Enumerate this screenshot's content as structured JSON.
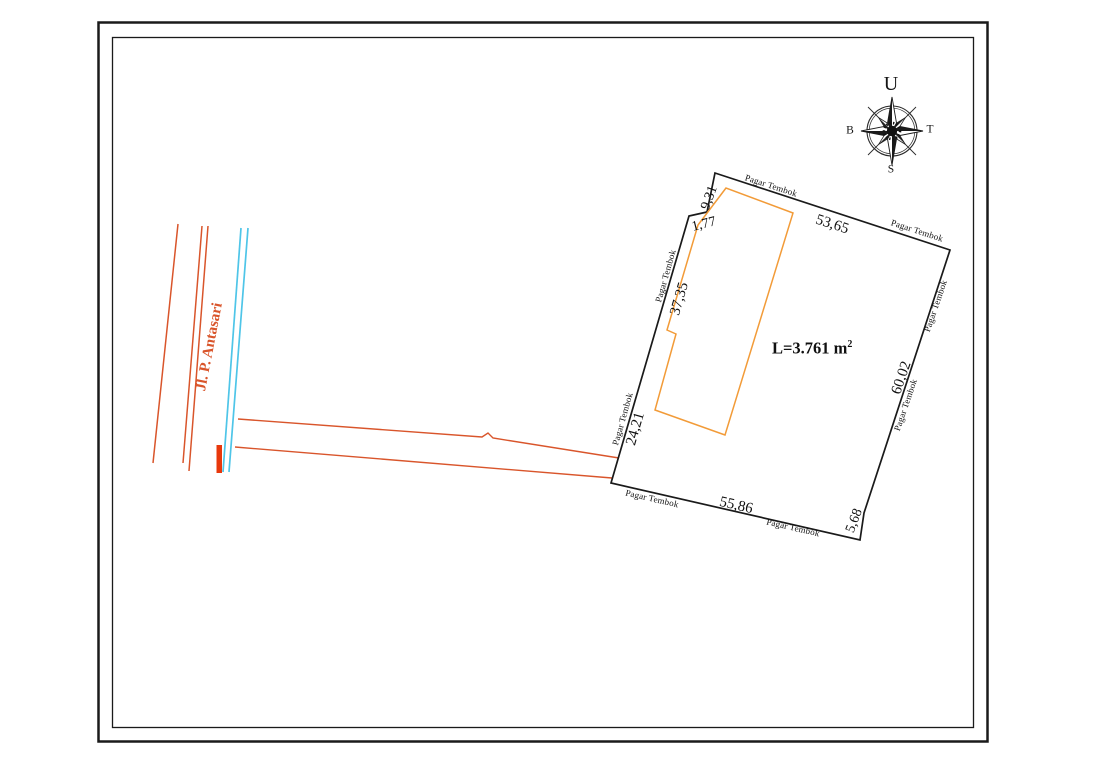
{
  "compass": {
    "north": "U",
    "east": "T",
    "south": "S",
    "west": "B"
  },
  "road": {
    "name": "Jl. P. Antasari"
  },
  "plot": {
    "wall_label": "Pagar Tembok",
    "area": {
      "prefix": "L=3.761 m",
      "sup": "2"
    },
    "dims": {
      "top": "53,65",
      "top_notch": "9,31",
      "notch_step": "1,77",
      "left_upper": "37,35",
      "left_lower": "24,21",
      "bottom": "55,86",
      "right": "60,02",
      "right_lower": "5,68"
    }
  },
  "colors": {
    "outline": "#1a1a1a",
    "building": "#f29b38",
    "road": "#d9552b",
    "water": "#4ec5e8",
    "gate": "#e8380c"
  }
}
